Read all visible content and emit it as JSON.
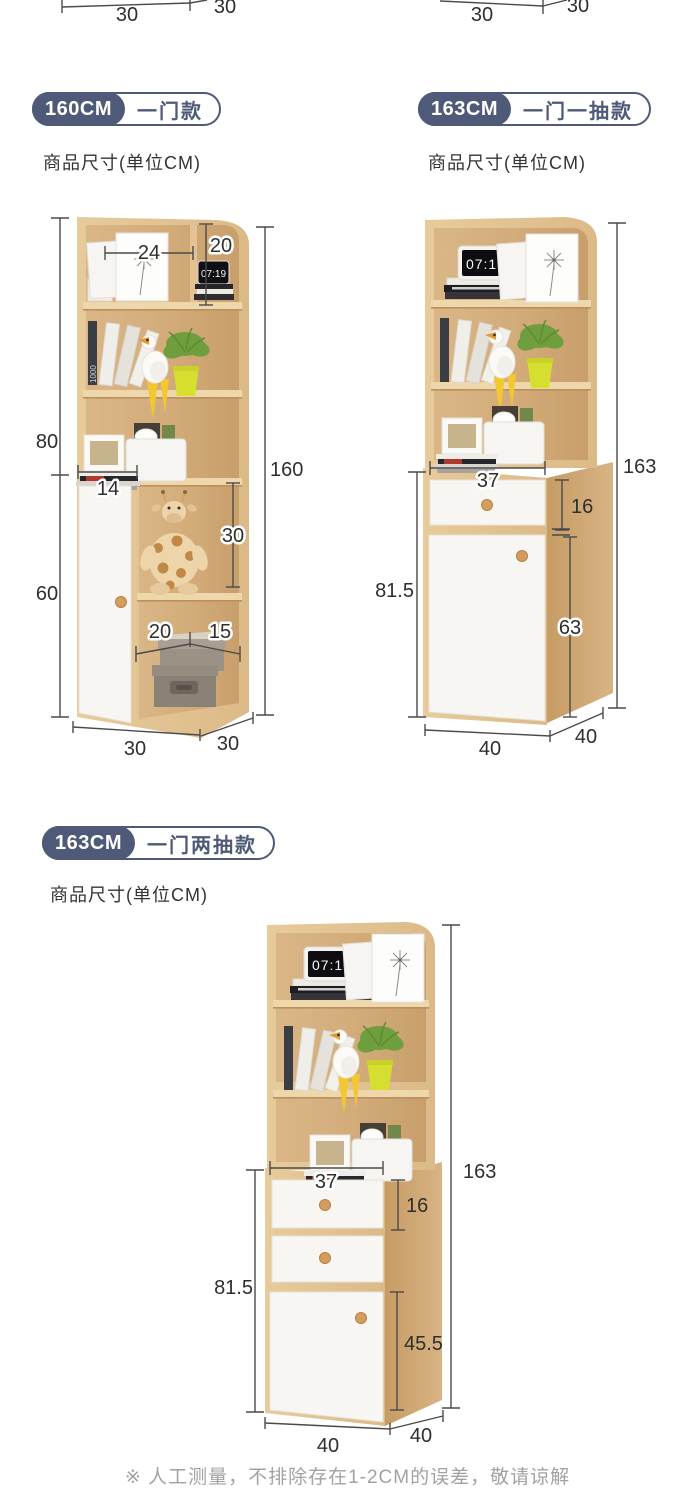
{
  "top_partial": {
    "left": {
      "front_width": "30",
      "side_depth": "30"
    },
    "right": {
      "front_width": "30",
      "side_depth": "30"
    }
  },
  "sections": [
    {
      "badge_size": "160CM",
      "badge_type": "一门款",
      "subtitle": "商品尺寸(单位CM)",
      "dims": {
        "top_shelf_width": "24",
        "top_right_height": "20",
        "upper_height": "80",
        "total_height": "160",
        "door_top_width": "14",
        "middle_shelf_height": "30",
        "lower_height": "60",
        "bottom_shelf_left_width": "20",
        "bottom_shelf_right_width": "15",
        "base_width": "30",
        "base_depth": "30"
      }
    },
    {
      "badge_size": "163CM",
      "badge_type": "一门一抽款",
      "subtitle": "商品尺寸(单位CM)",
      "dims": {
        "total_height": "163",
        "cabinet_width": "37",
        "drawer_height": "16",
        "lower_height": "81.5",
        "door_height": "63",
        "base_width": "40",
        "base_depth": "40"
      }
    },
    {
      "badge_size": "163CM",
      "badge_type": "一门两抽款",
      "subtitle": "商品尺寸(单位CM)",
      "dims": {
        "total_height": "163",
        "cabinet_width": "37",
        "drawer_height": "16",
        "lower_height": "81.5",
        "door_height": "45.5",
        "base_width": "40",
        "base_depth": "40"
      }
    }
  ],
  "decor": {
    "clock_time": "07:19",
    "book_spine": "1000"
  },
  "footer": {
    "note": "※ 人工测量，不排除存在1-2CM的误差，敬请谅解"
  }
}
